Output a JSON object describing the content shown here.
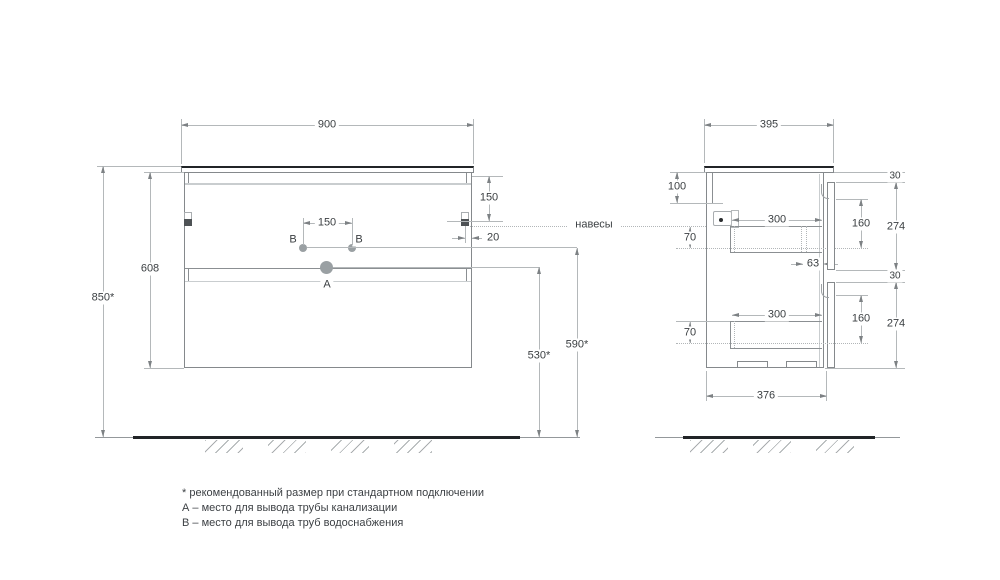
{
  "front_view": {
    "width_mm": "900",
    "height_overall": "850*",
    "height_body": "608",
    "hanger_from_top": "150",
    "hanger_from_side": "20",
    "holes_b_spacing": "150",
    "outlet_b_height": "590*",
    "outlet_a_height": "530*",
    "label_b_left": "B",
    "label_b_right": "B",
    "label_a": "A"
  },
  "side_view": {
    "depth_overall": "395",
    "depth_body": "376",
    "back_rail_height": "100",
    "drawer_top_back_gap": "70",
    "drawer_bottom_back_gap": "70",
    "drawer_top_depth": "300",
    "drawer_bottom_depth": "300",
    "slide_front_gap": "63",
    "reveal_top": "30",
    "reveal_middle": "30",
    "drawer_top_front_height": "274",
    "drawer_bottom_front_height": "274",
    "drawer_top_inner_height": "160",
    "drawer_bottom_inner_height": "160"
  },
  "annotations": {
    "hangers": "навесы"
  },
  "notes": {
    "recommended": "* рекомендованный размер при стандартном подключении",
    "a_legend": "А – место для вывода трубы канализации",
    "b_legend": "В – место для вывода труб водоснабжения"
  }
}
